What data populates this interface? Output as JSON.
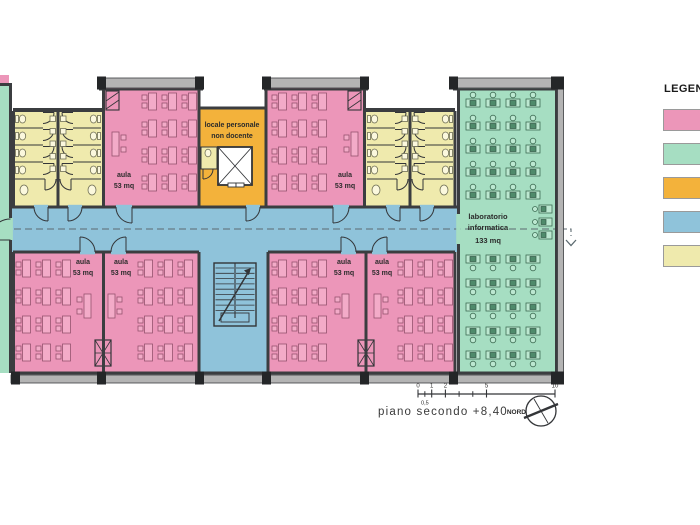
{
  "legend": {
    "title": "LEGENDA",
    "items": [
      {
        "id": "classrooms",
        "color": "#ec96b9"
      },
      {
        "id": "laboratory",
        "color": "#a6dec2"
      },
      {
        "id": "staff",
        "color": "#f3b23b"
      },
      {
        "id": "circulation",
        "color": "#8fc3da"
      },
      {
        "id": "services",
        "color": "#efeaad"
      }
    ]
  },
  "rooms": {
    "aula_top_left": {
      "name": "aula",
      "area": "53 mq"
    },
    "aula_top_right": {
      "name": "aula",
      "area": "53 mq"
    },
    "aula_bottom_1": {
      "name": "aula",
      "area": "53 mq"
    },
    "aula_bottom_2": {
      "name": "aula",
      "area": "53 mq"
    },
    "aula_bottom_3": {
      "name": "aula",
      "area": "53 mq"
    },
    "aula_bottom_4": {
      "name": "aula",
      "area": "53 mq"
    },
    "locale_personale": {
      "name": "locale personale",
      "name2": "non docente"
    },
    "laboratorio": {
      "name": "laboratorio",
      "name2": "informatica",
      "area": "133 mq"
    }
  },
  "footer": {
    "title": "piano secondo +8,40",
    "north": "NORD"
  },
  "scale_bar": {
    "major_labels": [
      {
        "t": "0",
        "u": 0
      },
      {
        "t": "1",
        "u": 1
      },
      {
        "t": "2",
        "u": 2
      },
      {
        "t": "5",
        "u": 5
      },
      {
        "t": "10",
        "u": 10
      }
    ],
    "minor_ticks": [
      0.5,
      3,
      4
    ],
    "sub_label": {
      "t": "0,5",
      "u": 0.5
    }
  },
  "colors": {
    "classroom": "#ec96b9",
    "classroom_furn": "#f3abc8",
    "classroom_line": "#95536f",
    "lab": "#a6dec2",
    "lab_furn": "#bce8d1",
    "lab_line": "#3d6b53",
    "monitor": "#4f8a6b",
    "staff": "#f3b23b",
    "corridor": "#8fc3da",
    "services": "#efeaad",
    "fixture": "#fbf8dd",
    "fixture_line": "#6f6f55",
    "wall": "#3b3d40",
    "wall_light": "#b4b4b4",
    "wall_cap": "#242628",
    "line": "#333538",
    "dash": "#5c6a70",
    "text": "#2b2b2b"
  }
}
